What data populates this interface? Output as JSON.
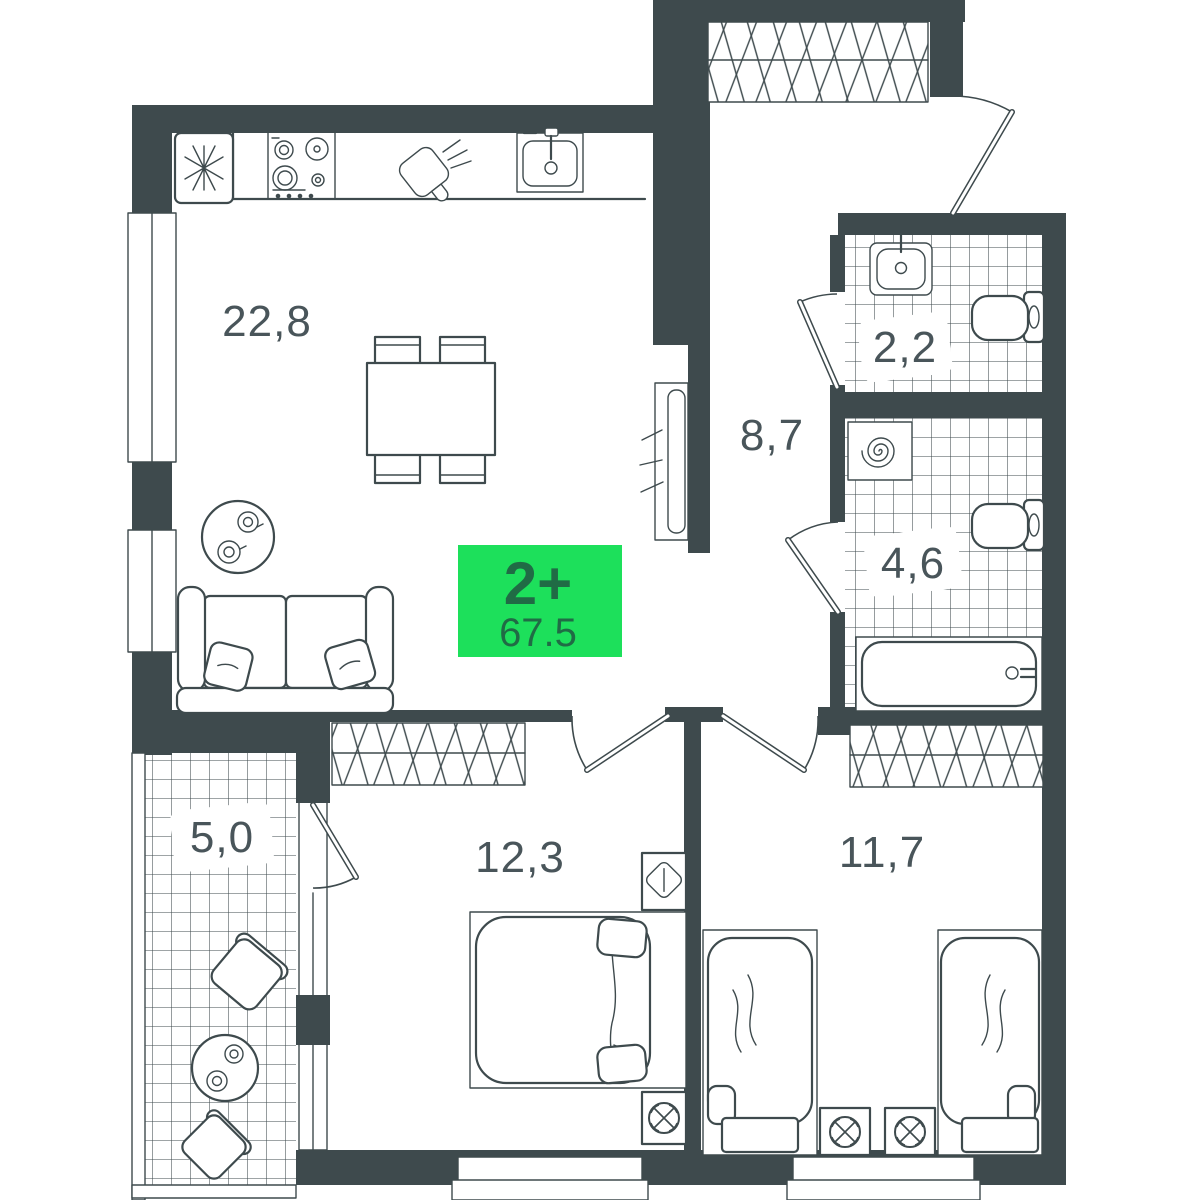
{
  "badge": {
    "rooms": "2+",
    "area": "67.5",
    "bg_color": "#1de05b",
    "text_color": "#206b45"
  },
  "rooms": {
    "kitchen_living": {
      "label": "22,8"
    },
    "hallway": {
      "label": "8,7"
    },
    "wc": {
      "label": "2,2"
    },
    "bathroom": {
      "label": "4,6"
    },
    "balcony": {
      "label": "5,0"
    },
    "bedroom_main": {
      "label": "12,3"
    },
    "bedroom_second": {
      "label": "11,7"
    }
  },
  "colors": {
    "wall": "#3e4a4d",
    "line": "#3e4a4d",
    "background": "#ffffff"
  }
}
